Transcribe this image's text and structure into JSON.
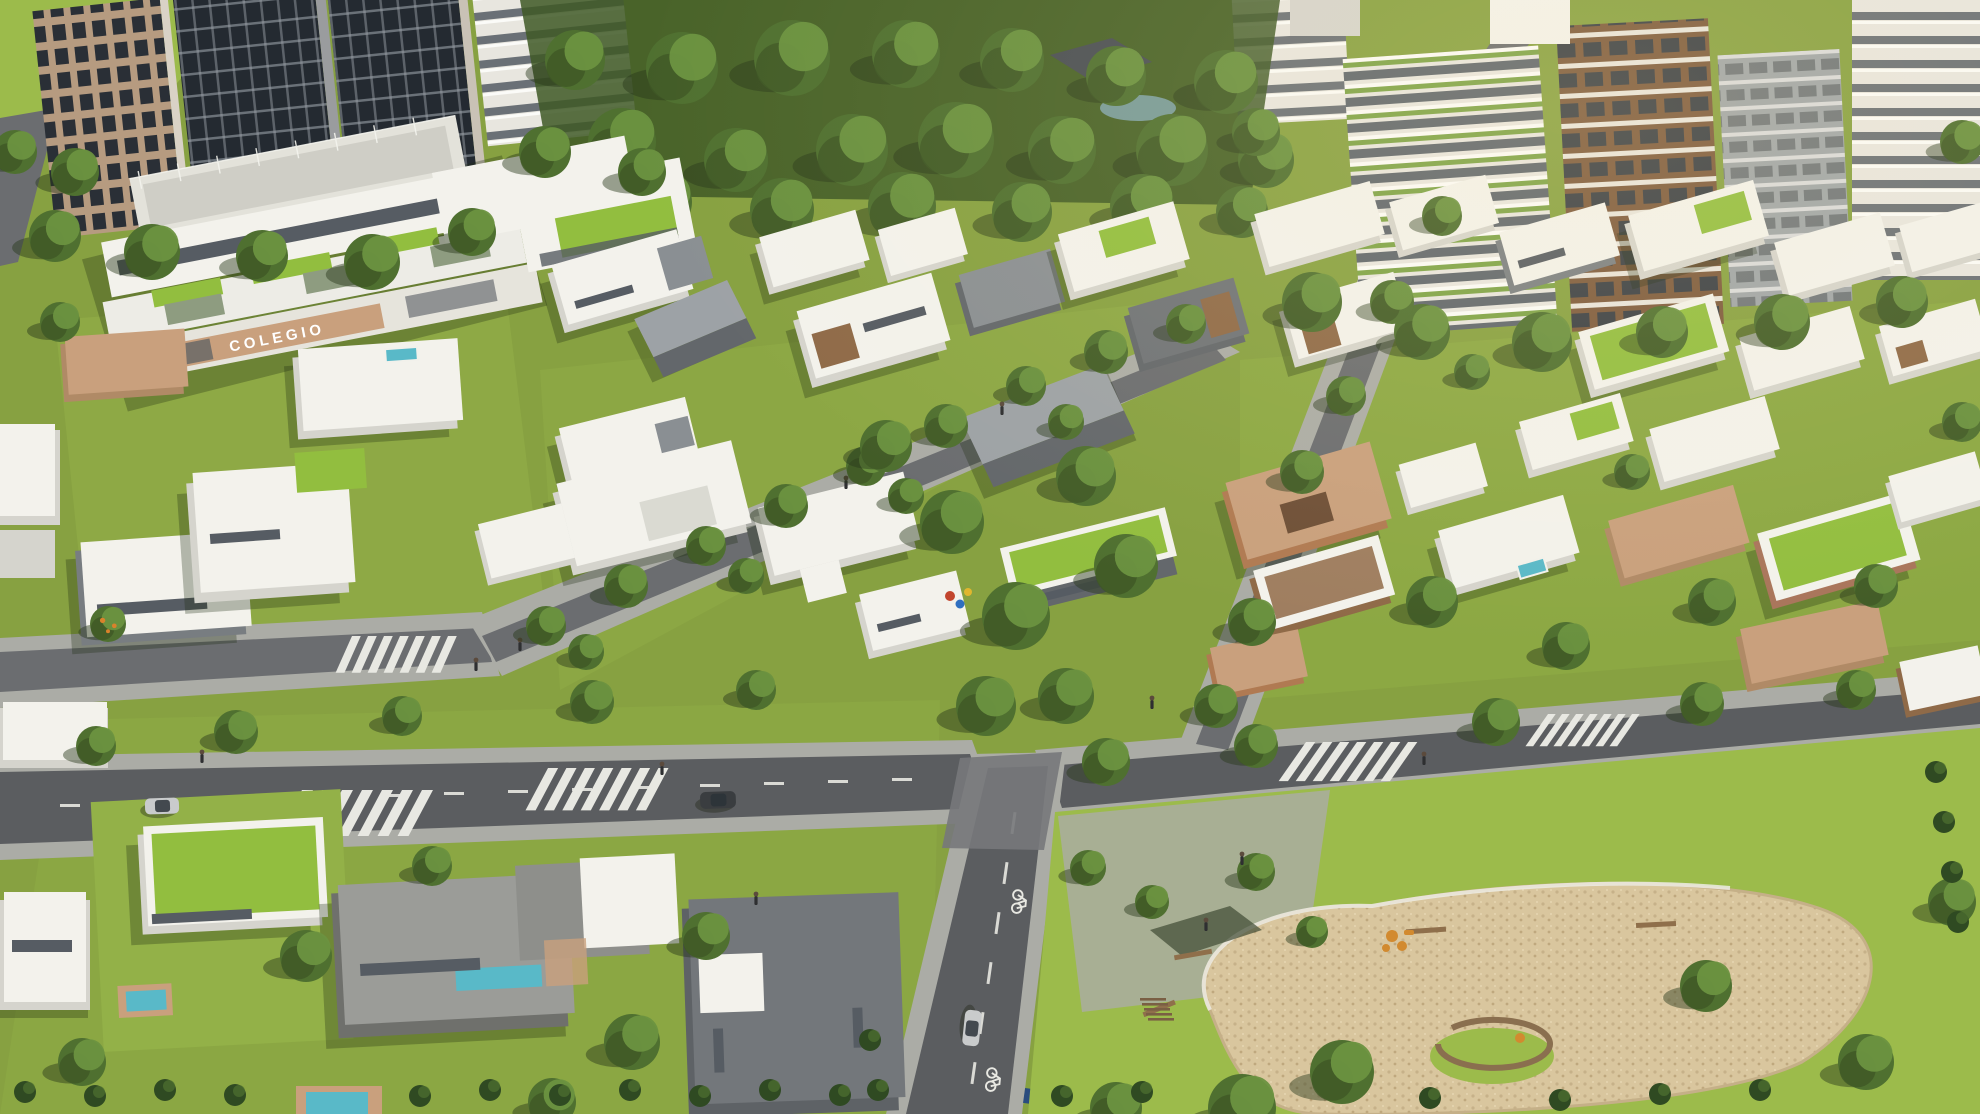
{
  "signage": {
    "school_sign": "COLEGIO"
  },
  "palette": {
    "grass": "#87A141",
    "lawn": "#93B148",
    "parkLawn": "#9CBB4B",
    "hedge": "#2F4A22",
    "treeDark": "#3E5826",
    "treeMid": "#4F7030",
    "treeLight": "#6C9240",
    "road": "#5B5D60",
    "roadLight": "#6B6D70",
    "sidewalk": "#ABACA6",
    "marking": "#E8E8E2",
    "white": "#F3F2EC",
    "wall": "#D5D4CD",
    "gray": "#8A8F93",
    "grayDark": "#63676B",
    "tan": "#C9A07D",
    "tanDark": "#B08A66",
    "brown": "#8F6A48",
    "brick": "#B07A52",
    "greenRoof": "#92BE3F",
    "water": "#59B9C8",
    "sand": "#D9C69E",
    "glass": "#565C63",
    "shadow": "#1E2A12",
    "towerGlass": "#242A31",
    "towerFrame": "#B69B80",
    "towerWhite": "#E8E6DF",
    "towerGreen": "#7DA347",
    "towerBrown": "#7D5A3D",
    "towerGray": "#9FA5A8",
    "carDark": "#3A3D40",
    "carSilver": "#C9CBCC",
    "playOrange": "#D28A2F",
    "playRed": "#C2452D",
    "playBlue": "#2F6FC0",
    "playYellow": "#E0B62E"
  }
}
